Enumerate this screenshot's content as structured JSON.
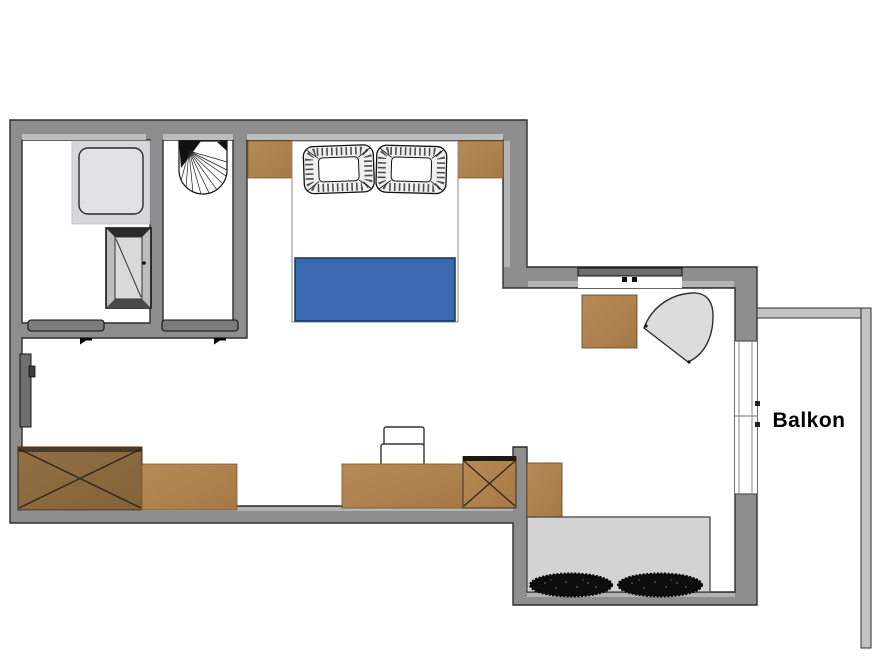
{
  "canvas": {
    "width": 880,
    "height": 660,
    "background": "#ffffff"
  },
  "labels": {
    "balcony": "Balkon"
  },
  "colors": {
    "wall": "#8e8e8e",
    "wall_outline": "#2f2f2f",
    "wall_light_edge": "#bdbdbd",
    "balcony_wall": "#c3c3c3",
    "wood_light": "#b1854f",
    "wood_dark": "#8e6c41",
    "blanket_blue": "#3a69b0",
    "blanket_outline": "#17345c",
    "platform_gray": "#d3d3d3",
    "shower_tray": "#d5d8d9",
    "armchair_gray": "#dcdcdc",
    "glass_bar": "#6e6e6e",
    "black_items": "#0d0d0d",
    "door_gray": "#6f6f6f",
    "text": "#000000"
  },
  "rooms": [
    {
      "name": "shower-room"
    },
    {
      "name": "wc-room"
    },
    {
      "name": "bedroom-living-area"
    },
    {
      "name": "entry-alcove"
    },
    {
      "name": "balcony",
      "label": "Balkon"
    }
  ],
  "inventory": {
    "fixtures": [
      "shower-tray",
      "washbasin",
      "interior-window",
      "entrance-door",
      "sliding-door-left",
      "sliding-door-right",
      "window",
      "balcony-door"
    ],
    "furniture": [
      "nightstand-left",
      "nightstand-right",
      "double-bed",
      "pillow-left",
      "pillow-right",
      "blue-blanket",
      "square-table",
      "armchair",
      "wardrobe",
      "sideboard",
      "desk",
      "desk-chair",
      "cross-cabinet",
      "side-cabinet",
      "bench-platform",
      "dark-mat-left",
      "dark-mat-right"
    ]
  }
}
